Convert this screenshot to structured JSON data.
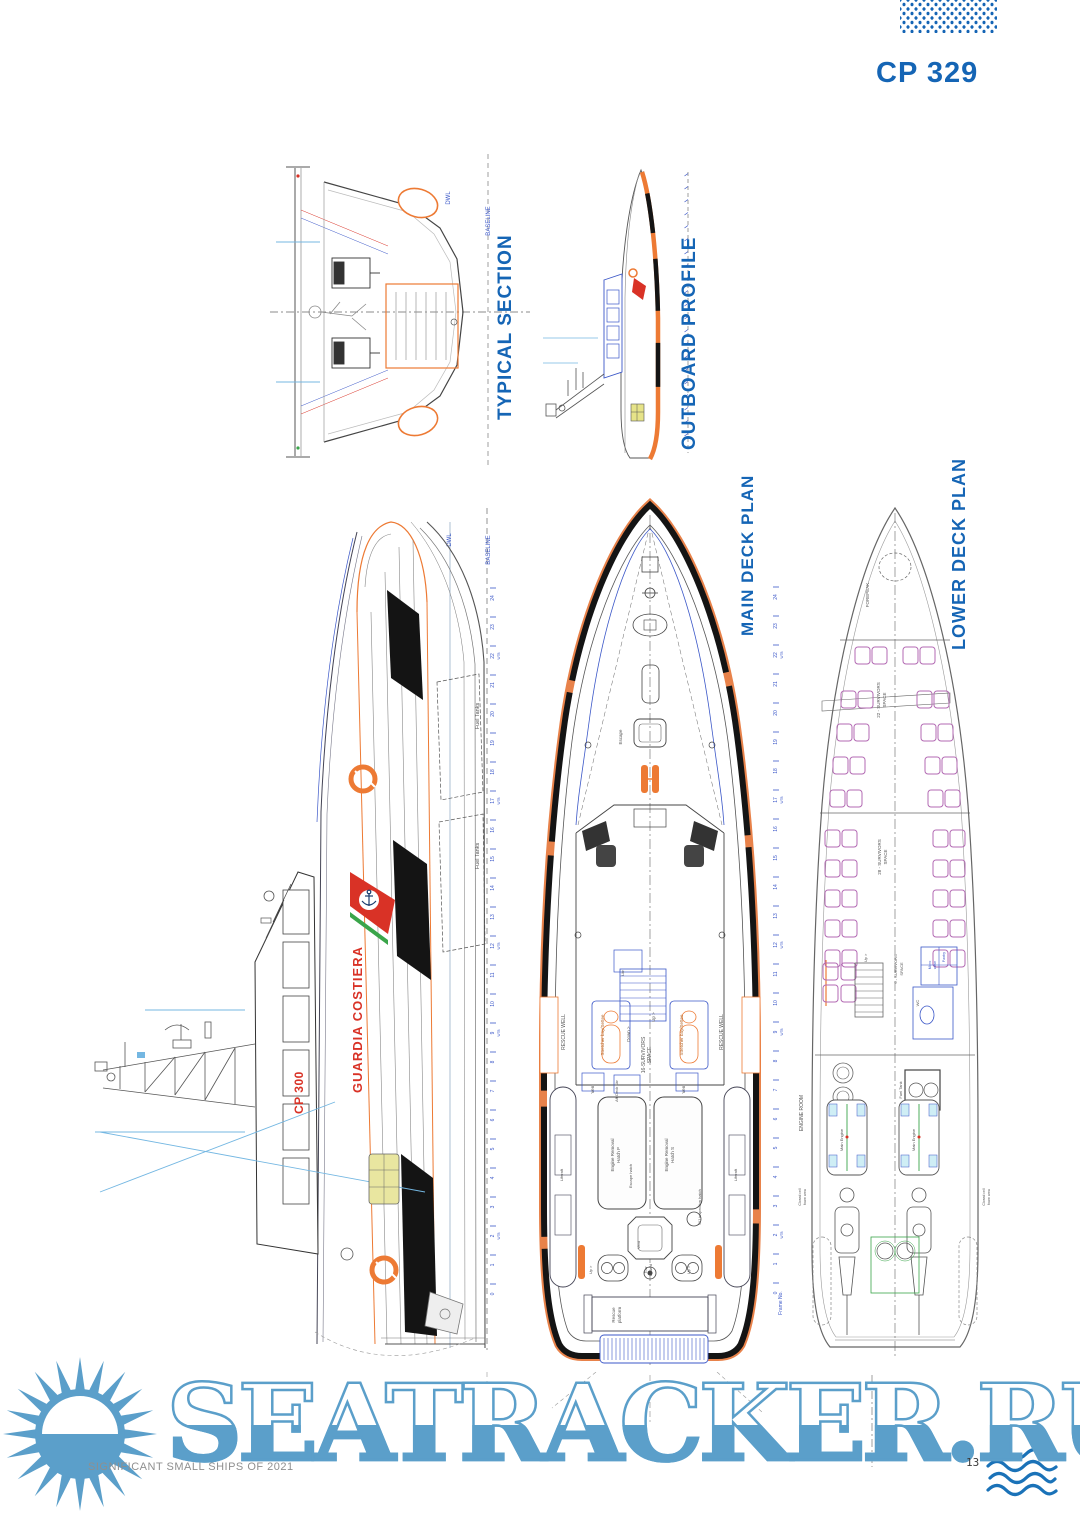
{
  "page": {
    "header_code": "CP 329",
    "watermark": "SEATRACKER.RU",
    "footer_left": "SIGNIFICANT SMALL SHIPS OF 2021",
    "page_number": "13"
  },
  "colors": {
    "heading_blue": "#1565b5",
    "drawing_blue": "#3b57c8",
    "dimension_blue": "#74b7e2",
    "hull_orange": "#ed7a34",
    "coastguard_red": "#d93226",
    "stripe_green": "#3aa54a",
    "seat_magenta": "#b36ab3",
    "watermark_blue": "#5b9fca",
    "fender_black": "#141414"
  },
  "typical_section": {
    "title": "TYPICAL SECTION",
    "dwl": "DWL",
    "baseline": "BASELINE"
  },
  "outboard_profile": {
    "title": "OUTBOARD PROFILE"
  },
  "profile": {
    "livery_name": "GUARDIA COSTIERA",
    "hull_number": "CP 300",
    "dwl": "DWL",
    "baseline": "BASELINE",
    "fuel_tanks_fwd": "Fuel Tanks",
    "fuel_tanks_aft": "Fuel Tanks"
  },
  "main_deck": {
    "title": "MAIN DECK PLAN",
    "escape": "Escape",
    "rescue_well_port": "RESCUE WELL",
    "rescue_well_stbd": "RESCUE WELL",
    "stretcher_port": "Stretcher bay/Settee",
    "stretcher_stbd": "Stretcher bay/Settee",
    "down": "Down >",
    "up": "Up >",
    "survivors16_l1": "16-SURVIVORS",
    "survivors16_l2": "SPACE",
    "vent_port": "Vent",
    "vent_stbd": "Vent",
    "aft_deck_lkr": "Aft Deck Lkr",
    "lkr": "Lkr",
    "engine_hatch_p_l1": "Engine Removal",
    "engine_hatch_p_l2": "Hatch P",
    "engine_hatch_s_l1": "Engine Removal",
    "engine_hatch_s_l2": "Hatch S",
    "escape_hatch": "Escape hatch",
    "wj_hatch": "WJ inspection hatch",
    "liferaft_port": "Liferaft",
    "liferaft_stbd": "Liferaft",
    "vent_aft": "Vent",
    "up_aft_port": "Up >",
    "up_aft_stbd": "Up >",
    "tow_l1": "Tow",
    "tow_l2": "Bollard",
    "rescue_platform_l1": "Rescue",
    "rescue_platform_l2": "platform",
    "frame_no": "Frame No."
  },
  "lower_deck": {
    "title": "LOWER  DECK PLAN",
    "forepeak": "FOREPEAK",
    "survivors22_l1": "22 - SURVIVORS",
    "survivors22_l2": "SPACE",
    "survivors28_l1": "28 - SURVIVORS",
    "survivors28_l2": "SPACE",
    "survivors6_l1": "6 - SURVIVORS",
    "survivors6_l2": "SPACE",
    "up": "Up >",
    "wc": "WC",
    "micro_l1": "Micro",
    "micro_l2": "wave",
    "pantry": "Pantry",
    "engine_room": "ENGINE ROOM",
    "fuel_tank": "Fuel Tank",
    "main_engine_p": "Main Engine",
    "main_engine_s": "Main Engine",
    "foam_port_l1": "Closed cell",
    "foam_port_l2": "foam area",
    "foam_stbd_l1": "Closed cell",
    "foam_stbd_l2": "foam area"
  },
  "frames": {
    "labels": [
      "24",
      "23",
      "22",
      "21",
      "20",
      "19",
      "18",
      "17",
      "16",
      "15",
      "14",
      "13",
      "12",
      "11",
      "10",
      "9",
      "8",
      "7",
      "6",
      "5",
      "4",
      "3",
      "2",
      "1",
      "0"
    ],
    "wtb_frames": [
      "22",
      "17",
      "12",
      "9",
      "2"
    ],
    "wtb_text": "WTB"
  }
}
